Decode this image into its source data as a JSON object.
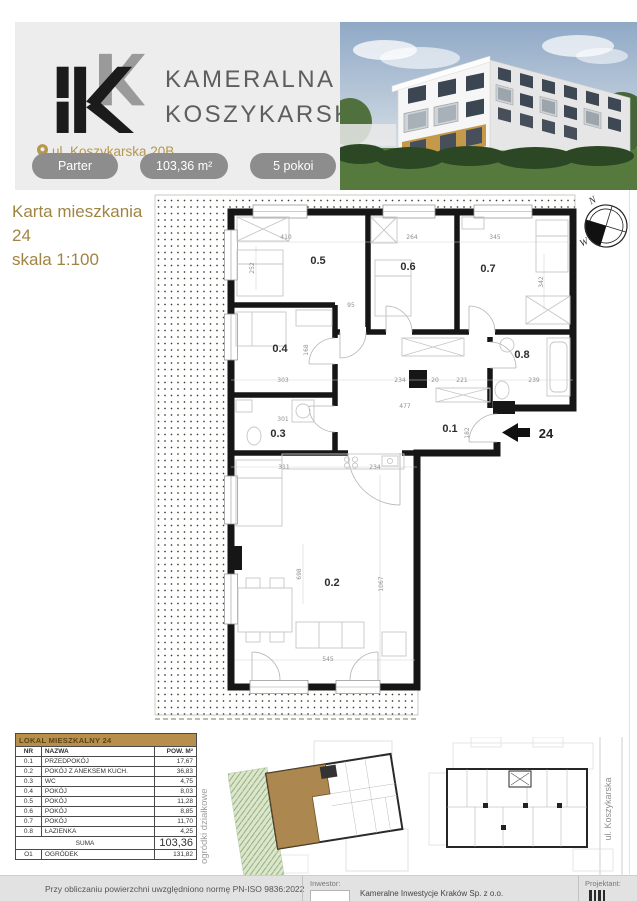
{
  "header": {
    "brand_line1": "KAMERALNA",
    "brand_line2": "KOSZYKARSKA",
    "address": "ul. Koszykarska 20B",
    "badge_floor": "Parter",
    "badge_area": "103,36 m²",
    "badge_rooms": "5 pokoi"
  },
  "card": {
    "title_line1": "Karta mieszkania",
    "title_line2": "24",
    "title_line3": "skala 1:100"
  },
  "plan": {
    "rooms": [
      "0.5",
      "0.6",
      "0.7",
      "0.4",
      "0.8",
      "0.3",
      "0.1",
      "0.2"
    ],
    "dimensions": [
      "410",
      "264",
      "345",
      "252",
      "342",
      "95",
      "303",
      "168",
      "234",
      "20",
      "221",
      "239",
      "477",
      "301",
      "182",
      "311",
      "234",
      "698",
      "1067",
      "545"
    ],
    "entrance_label": "24",
    "compass_n": "N",
    "compass_w": "W"
  },
  "table": {
    "title": "LOKAL MIESZKALNY 24",
    "col_nr": "NR",
    "col_name": "NAZWA",
    "col_pow": "POW. M²",
    "rows": [
      [
        "0.1",
        "PRZEDPOKÓJ",
        "17,67"
      ],
      [
        "0.2",
        "POKÓJ Z ANEKSEM KUCH.",
        "36,83"
      ],
      [
        "0.3",
        "WC",
        "4,75"
      ],
      [
        "0.4",
        "POKÓJ",
        "8,03"
      ],
      [
        "0.5",
        "POKÓJ",
        "11,28"
      ],
      [
        "0.6",
        "POKÓJ",
        "8,85"
      ],
      [
        "0.7",
        "POKÓJ",
        "11,70"
      ],
      [
        "0.8",
        "ŁAZIENKA",
        "4,25"
      ]
    ],
    "suma_label": "SUMA",
    "suma_value": "103,36",
    "garden_row": [
      "O1",
      "OGRÓDEK",
      "131,82"
    ]
  },
  "annotations": {
    "garden_area_label": "ogródki działkowe",
    "street_label": "ul. Koszykarska"
  },
  "footer": {
    "norm_text": "Przy obliczaniu powierzchni uwzględniono normę PN-ISO 9836:2022",
    "investor_label": "Inwestor:",
    "investor_name": "Kameralne Inwestycje Kraków Sp. z o.o.",
    "designer_label": "Projektant:"
  },
  "colors": {
    "accent_gold": "#b5974f",
    "table_header_bg": "#b78f4c",
    "badge_gray": "#8d8d8d",
    "wall_black": "#161616",
    "garden_green": "#7fa06a"
  }
}
